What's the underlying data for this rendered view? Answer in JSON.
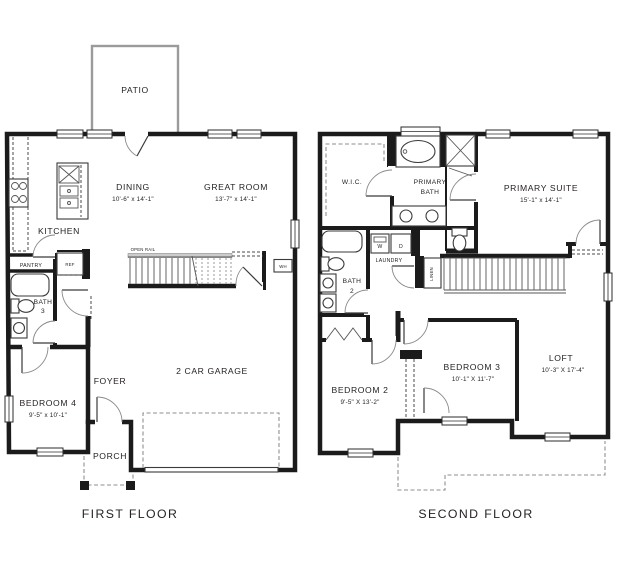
{
  "first_floor": {
    "caption": "FIRST FLOOR",
    "rooms": {
      "patio": "PATIO",
      "dining": {
        "name": "DINING",
        "dims": "10'-6\" x 14'-1\""
      },
      "great_room": {
        "name": "GREAT ROOM",
        "dims": "13'-7\" x 14'-1\""
      },
      "kitchen": "KITCHEN",
      "pantry": "PANTRY",
      "ref": "REF",
      "open_rail": "OPEN RAIL",
      "water_heater": "WH",
      "bath3": {
        "line1": "BATH",
        "line2": "3"
      },
      "foyer": "FOYER",
      "garage": "2 CAR GARAGE",
      "bedroom4": {
        "name": "BEDROOM 4",
        "dims": "9'-5\" x 10'-1\""
      },
      "porch": "PORCH"
    }
  },
  "second_floor": {
    "caption": "SECOND FLOOR",
    "rooms": {
      "wic": "W.I.C.",
      "primary_bath": {
        "line1": "PRIMARY",
        "line2": "BATH"
      },
      "primary_suite": {
        "name": "PRIMARY SUITE",
        "dims": "15'-1\" x 14'-1\""
      },
      "laundry": {
        "name": "LAUNDRY",
        "washer": "W",
        "dryer": "D"
      },
      "linen": "LINEN",
      "bath2": {
        "line1": "BATH",
        "line2": "2"
      },
      "bedroom2": {
        "name": "BEDROOM 2",
        "dims": "9'-5\" X 13'-2\""
      },
      "bedroom3": {
        "name": "BEDROOM 3",
        "dims": "10'-1\" X 11'-7\""
      },
      "loft": {
        "name": "LOFT",
        "dims": "10'-3\" X 17'-4\""
      }
    }
  }
}
